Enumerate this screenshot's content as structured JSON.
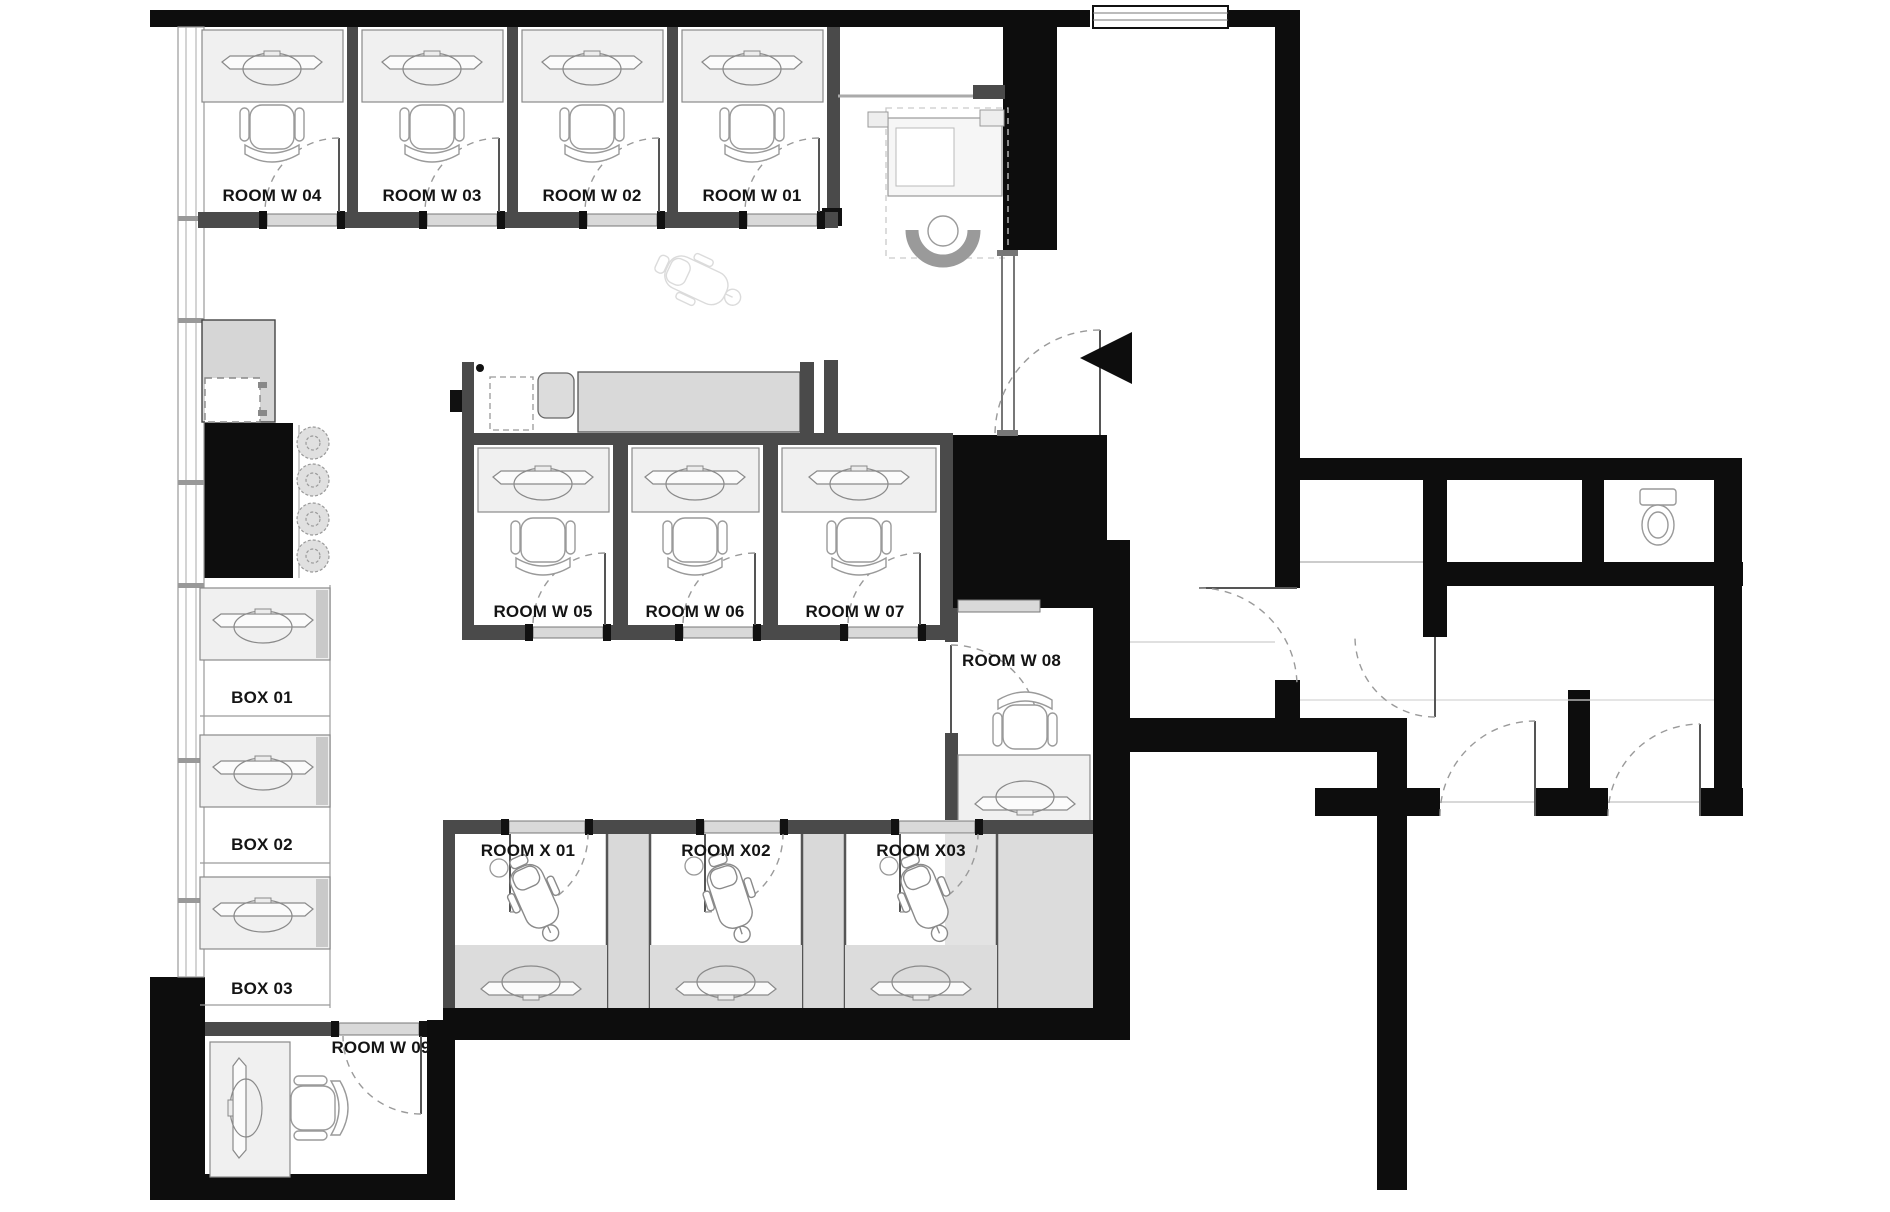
{
  "plan": {
    "title": "Office floor plan",
    "rooms": {
      "w01": {
        "label": "ROOM W 01"
      },
      "w02": {
        "label": "ROOM W 02"
      },
      "w03": {
        "label": "ROOM W 03"
      },
      "w04": {
        "label": "ROOM W 04"
      },
      "w05": {
        "label": "ROOM W 05"
      },
      "w06": {
        "label": "ROOM W 06"
      },
      "w07": {
        "label": "ROOM W 07"
      },
      "w08": {
        "label": "ROOM W 08"
      },
      "w09": {
        "label": "ROOM W 09"
      },
      "x01": {
        "label": "ROOM X 01"
      },
      "x02": {
        "label": "ROOM X02"
      },
      "x03": {
        "label": "ROOM X03"
      },
      "box01": {
        "label": "BOX 01"
      },
      "box02": {
        "label": "BOX 02"
      },
      "box03": {
        "label": "BOX 03"
      }
    },
    "colors": {
      "outer_wall": "#0d0d0d",
      "partition_wall": "#4a4a4a",
      "desk_fill": "#f0f0f0",
      "counter_fill": "#d9d9d9",
      "floor_gray": "#dcdcdc",
      "furniture_line": "#8a8a8a",
      "label_text": "#141414"
    }
  }
}
